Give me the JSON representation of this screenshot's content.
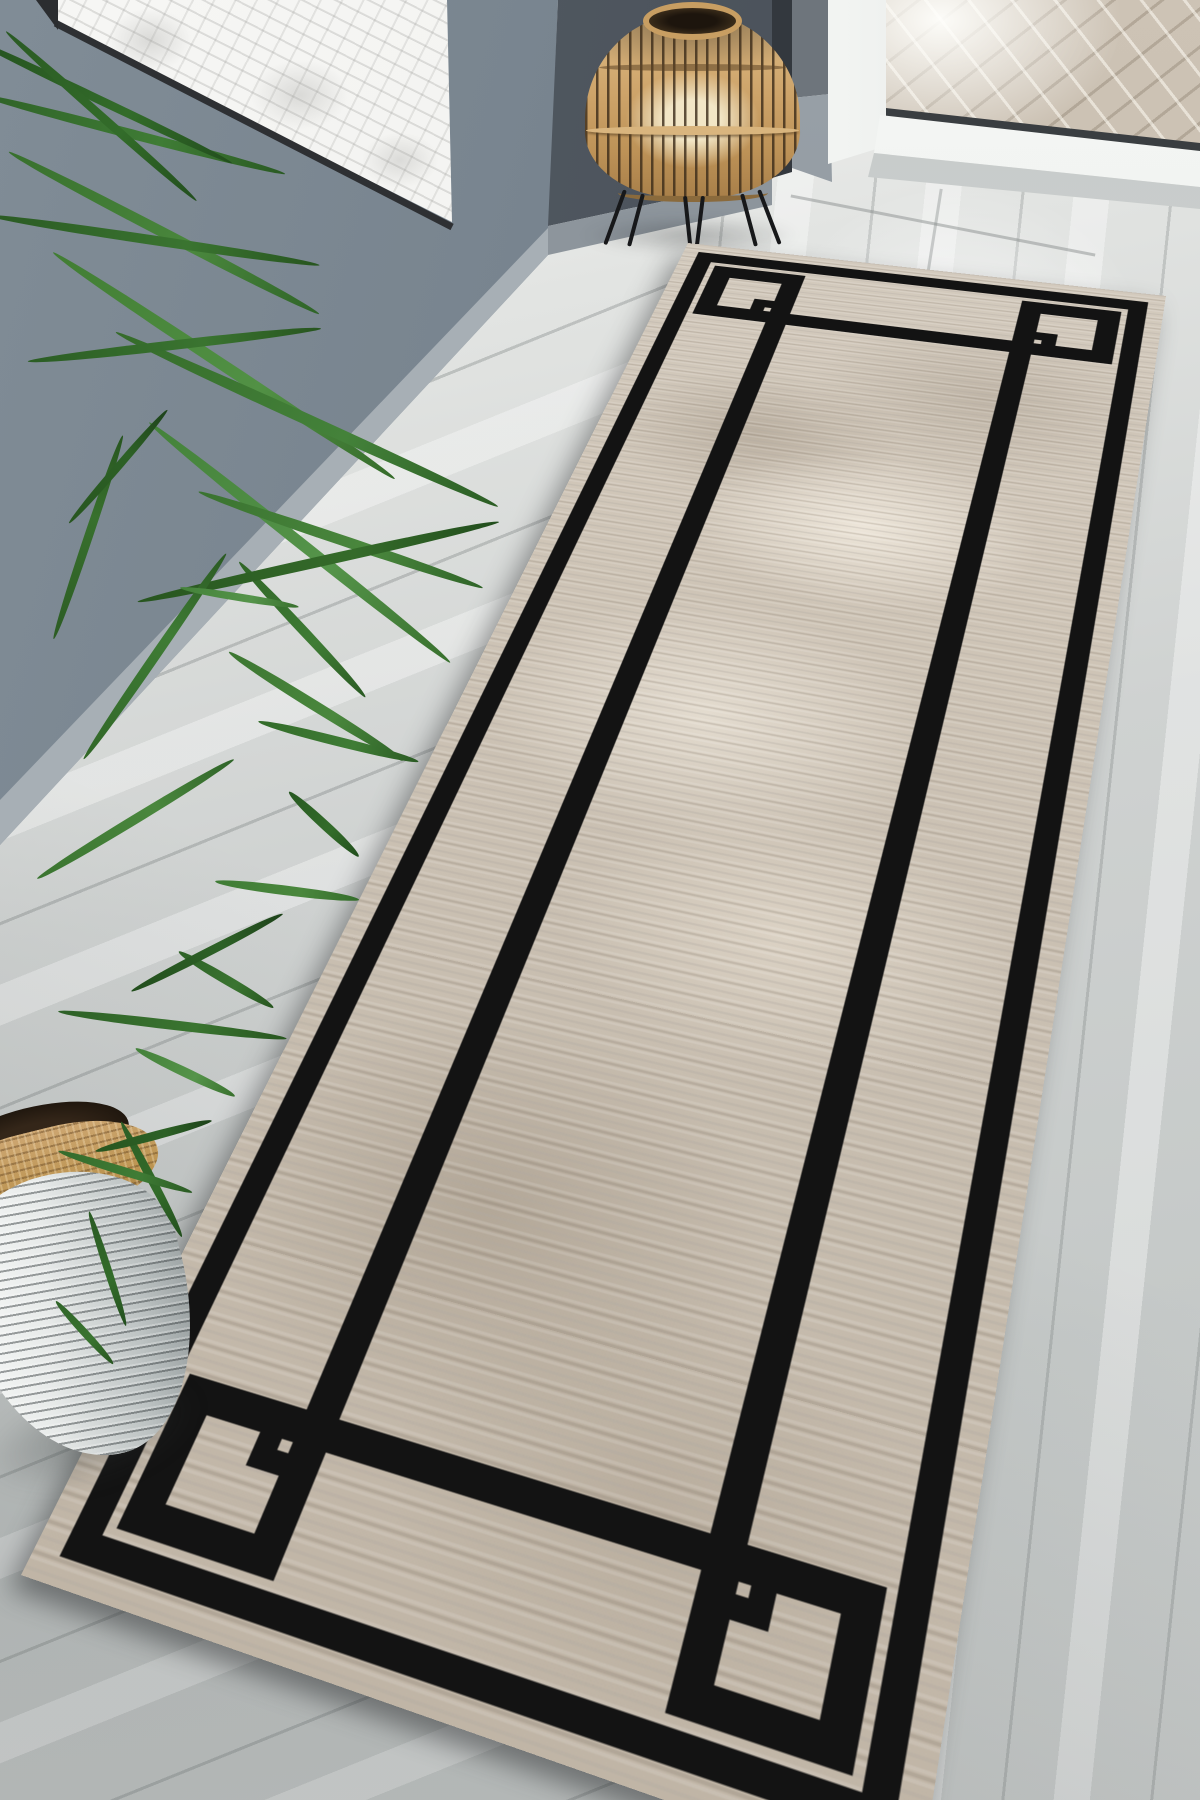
{
  "scene": {
    "type": "product-photo",
    "subject": "beige runner rug with black geometric double-line border, shown in perspective in a hallway",
    "objects": [
      {
        "id": "runner-rug",
        "description": "distressed beige-taupe runner with black outer and inner border lines and interlocking square corner motifs"
      },
      {
        "id": "gray-wall",
        "description": "gray-blue hallway wall with light baseboard"
      },
      {
        "id": "wall-art",
        "description": "white framed artwork with faint gray ornament, upper left, seen at an angle"
      },
      {
        "id": "palm-plant",
        "description": "areca palm with long green blades, left side"
      },
      {
        "id": "woven-planter",
        "description": "ribbed white-gray planter with jute rope rim and dark soil, bottom left"
      },
      {
        "id": "rattan-lantern",
        "description": "bamboo cage candle lantern on black hairpin tripod legs, top center"
      },
      {
        "id": "glass-door",
        "description": "white-framed glass door, top right"
      },
      {
        "id": "brick-paving",
        "description": "beige herringbone brick paving visible through door glass"
      },
      {
        "id": "wood-floor",
        "description": "light gray wood-look plank floor laid diagonally"
      }
    ],
    "palette": {
      "wall": "#75818c",
      "wall_shadow": "#4a515a",
      "baseboard": "#a7afb5",
      "floor": "#cfd2d1",
      "floor_light": "#f0f0ee",
      "rug_field": "#cbc1b3",
      "rug_field_light": "#e9e2d6",
      "rug_field_dark": "#a89d8e",
      "rug_border_black": "#131313",
      "lantern_bamboo": "#cda369",
      "candle": "#f2e6c6",
      "plant_green_dark": "#24511f",
      "plant_green_mid": "#35702c",
      "plant_green_light": "#44823a",
      "planter_body": "#e7eae9",
      "planter_jute": "#bb934f",
      "soil": "#2a1f14",
      "art_white": "#f2f2f0",
      "bricks": "#c3b9ab",
      "door_frame_white": "#e7eae8"
    }
  }
}
